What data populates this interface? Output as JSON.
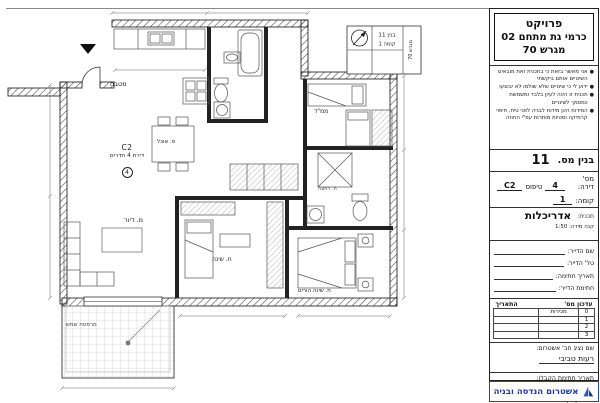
{
  "title_block": {
    "project": {
      "label": "פרויקט",
      "line1": "כרמי גת מתחם 02",
      "line2": "מגרש 70"
    },
    "notes": [
      "אני מאשר בזאת כי בתכנית זאת מובאים השינויים אותם ביקשתי",
      "ידוע לי כי שינויים שלא שולמו לא יבוצעו",
      "תכנית זו הינה לעיון בלבד ומשמשת כמסמך לשינויים",
      "המידות הינן מידות לבניה לפני טיח, חיפוי קרמיקה וסטיות מותרות עפ\"י החוזה"
    ],
    "building": {
      "label": "בנין מס.",
      "value": "11"
    },
    "apartment": {
      "label": "מס' דירה:",
      "value": "4",
      "type_label": "טיפוס",
      "type_value": "C2"
    },
    "floor": {
      "label": "קומה:",
      "value": "1"
    },
    "plan_type": {
      "label": "תכנית:",
      "value": "אדריכלות"
    },
    "scale": {
      "label": "קנה מידה:",
      "value": "1:50"
    },
    "fields": [
      {
        "label": "שם הדייר:"
      },
      {
        "label": "טל' הדייר:"
      },
      {
        "label": "תאריך חתימה:"
      },
      {
        "label": "חתימת הדייר:"
      }
    ],
    "revisions": {
      "col_no": "עדכון מס'",
      "col_date": "התאריך",
      "rows": [
        {
          "no": "0",
          "desc": "מכירות",
          "date": ""
        },
        {
          "no": "1",
          "desc": "",
          "date": ""
        },
        {
          "no": "2",
          "desc": "",
          "date": ""
        },
        {
          "no": "3",
          "desc": "",
          "date": ""
        }
      ]
    },
    "rep": {
      "label": "שם נציג חב' אשטרום:",
      "value": "רעות טביבי"
    },
    "contractor_date_label": "תאריך חתימת הקבלן:",
    "contractor_sig_label": "שם הקבלן וחתימתו:",
    "logo": {
      "text": "אשטרום הנדסה ובניה",
      "color": "#1d3f9e"
    }
  },
  "plan": {
    "labels": {
      "apartment_type": "C2",
      "apartment_desc": "דירת 4 חדרים",
      "apartment_num": "4",
      "kitchen": "מטבח",
      "dining": "פ. אוכל",
      "living": "מ. דיור",
      "mamad": "ממ\"ד",
      "bedroom": "ח. שינה",
      "master_bedroom": "ח. שינה הורים",
      "balcony": "מרפסת שמש",
      "bath": "ח. רחצה"
    },
    "keyplan": {
      "building": "בנין 11",
      "floor": "קומה 1",
      "plot": "מגרש 70"
    }
  }
}
